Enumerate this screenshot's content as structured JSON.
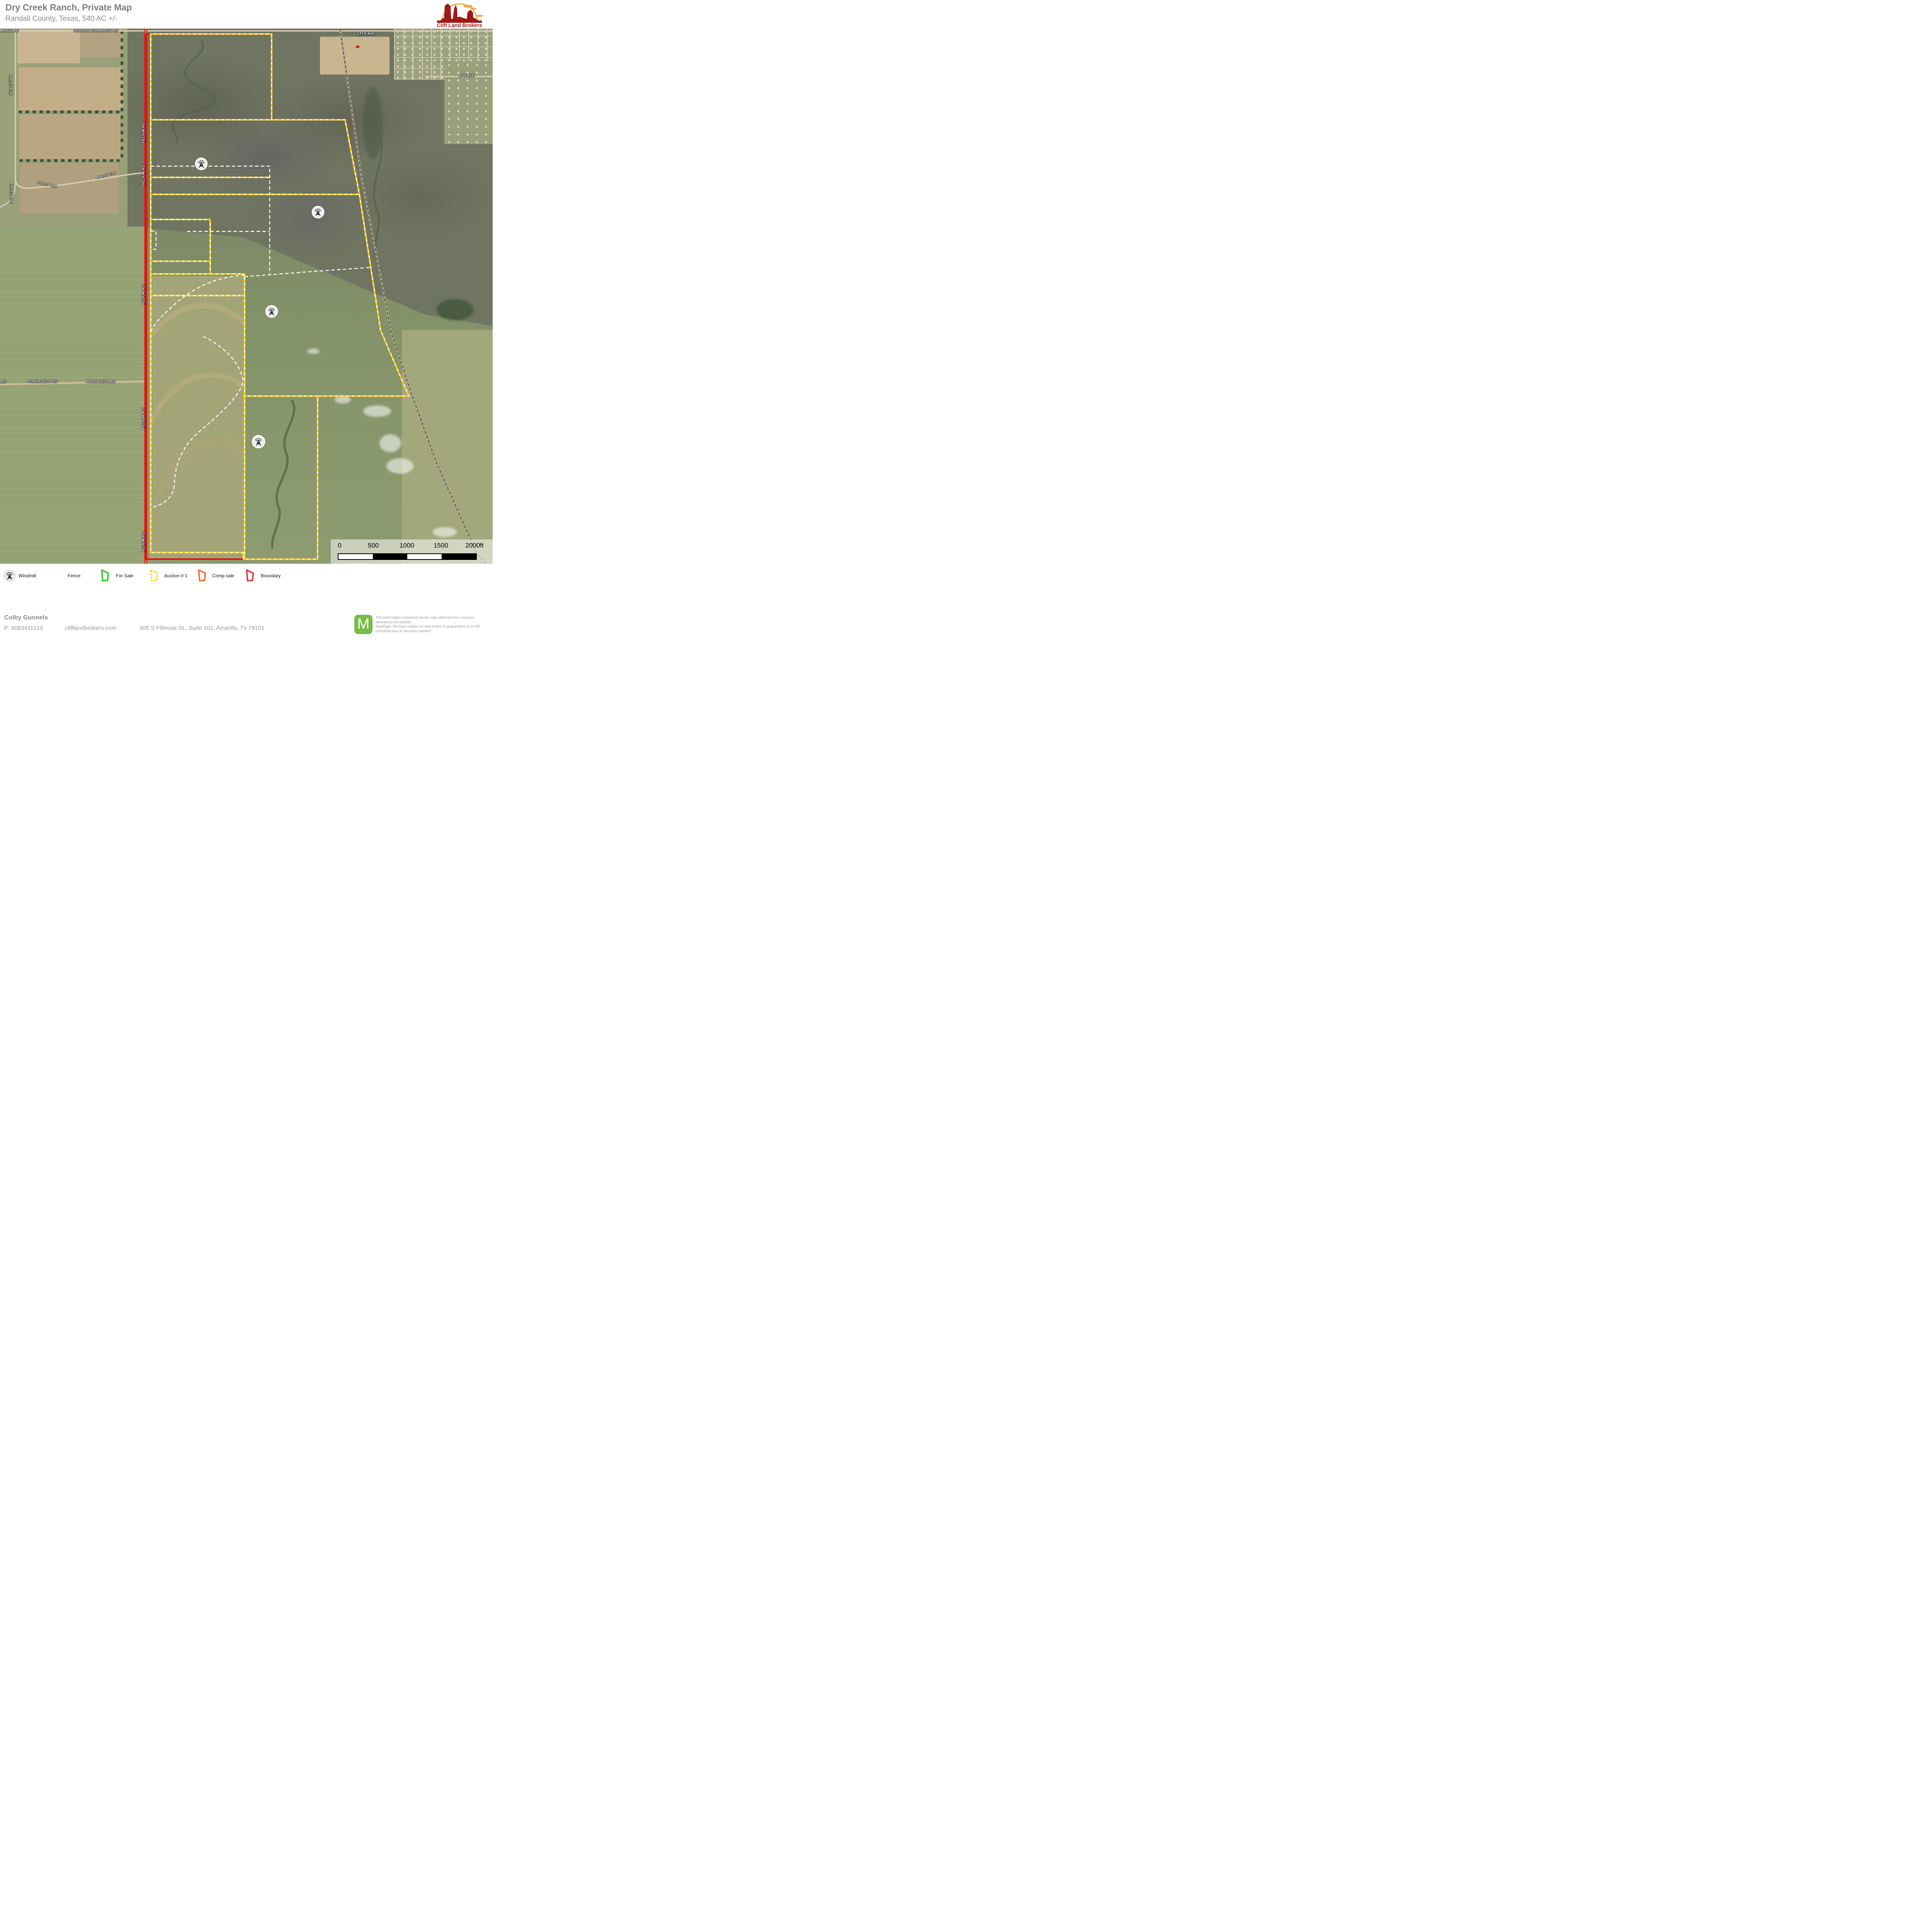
{
  "header": {
    "title": "Dry Creek Ranch, Private Map",
    "subtitle": "Randall County, Texas, 540 AC +/-",
    "logo_text": "Clift Land Brokers"
  },
  "map": {
    "labels": {
      "cummings_partial": "MINGS RD",
      "gordon": "GORDON CUMMINGS RD",
      "ave13": "13TH AVE",
      "ave8": "8TH AVE",
      "haley": "HALEY CIR",
      "pondaseta": "PONDASETA RD",
      "pondaseta_partial": "RD",
      "helium": "HELIUM RD"
    },
    "scale_bar": {
      "ticks": [
        "0",
        "500",
        "1000",
        "1500",
        "2000ft"
      ]
    }
  },
  "legend": {
    "items": [
      {
        "label": "Windmill"
      },
      {
        "label": "Fence"
      },
      {
        "label": "For Sale"
      },
      {
        "label": "Auction  # 1"
      },
      {
        "label": "Comp sale"
      },
      {
        "label": "Boundary"
      }
    ]
  },
  "footer": {
    "agent": "Colby Gunnels",
    "phone": "P: 8063411515",
    "website": "cliftlandbrokers.com",
    "address": "905 S Fillmore St., Suite 102, Amarillo, Tx 79101",
    "badge_letter": "M",
    "disclaimer": {
      "l1": "The information contained herein was obtained from sources",
      "l2": "deemed to be reliable.",
      "l3": " MapRight Services makes no warranties or guarantees as to the",
      "l4": "completeness or accuracy thereof."
    }
  },
  "colors": {
    "boundary_red": "#e01414",
    "auction_yellow": "#ffd200",
    "fence_white": "#ffffff",
    "for_sale_green": "#38c633",
    "comp_sale_orange": "#ee7233",
    "legend_boundary_red": "#d93a3a",
    "logo_red": "#9e1a16",
    "mapright_green": "#77bc44",
    "title_gray": "#7d7d7d"
  }
}
